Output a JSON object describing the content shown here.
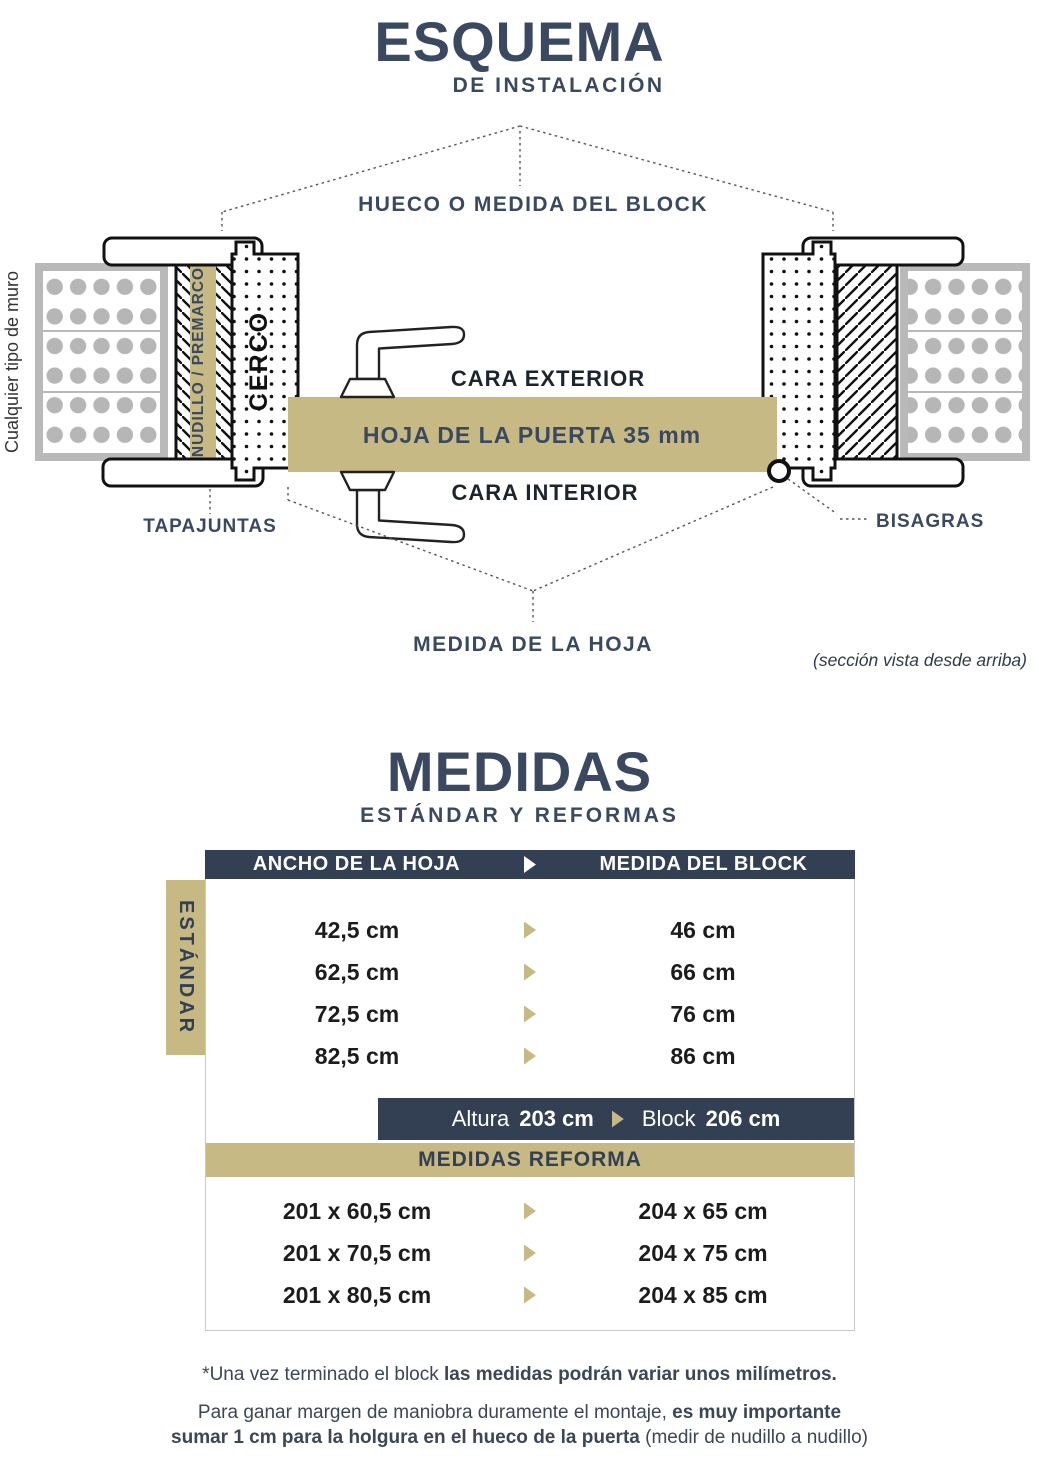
{
  "colors": {
    "navy": "#3a4960",
    "bar_navy": "#333f52",
    "gold": "#c6b983",
    "wall_gray": "#b6b6b6",
    "ink": "#1d242e"
  },
  "esquema": {
    "title": "ESQUEMA",
    "subtitle": "DE INSTALACIÓN",
    "hueco_label": "HUECO O MEDIDA DEL BLOCK",
    "wall_label": "Cualquier tipo de muro",
    "nudillo_label": "NUDILLO / PREMARCO",
    "cerco_label": "CERCO",
    "cara_exterior": "CARA EXTERIOR",
    "hoja_label": "HOJA DE LA PUERTA  35 mm",
    "cara_interior": "CARA INTERIOR",
    "tapajuntas_label": "TAPAJUNTAS",
    "bisagras_label": "BISAGRAS",
    "medida_hoja_label": "MEDIDA DE LA HOJA",
    "section_note": "(sección vista desde arriba)"
  },
  "medidas": {
    "title": "MEDIDAS",
    "subtitle": "ESTÁNDAR Y REFORMAS",
    "header_left": "ANCHO DE LA HOJA",
    "header_right": "MEDIDA DEL BLOCK",
    "estandar_tab": "ESTÁNDAR",
    "standard_rows": [
      {
        "hoja": "42,5 cm",
        "block": "46 cm"
      },
      {
        "hoja": "62,5 cm",
        "block": "66 cm"
      },
      {
        "hoja": "72,5 cm",
        "block": "76 cm"
      },
      {
        "hoja": "82,5 cm",
        "block": "86 cm"
      }
    ],
    "altura": {
      "label_a": "Altura",
      "value_a": "203 cm",
      "label_b": "Block",
      "value_b": "206 cm"
    },
    "reforma_header": "MEDIDAS REFORMA",
    "reforma_rows": [
      {
        "hoja": "201 x 60,5 cm",
        "block": "204 x 65 cm"
      },
      {
        "hoja": "201 x 70,5 cm",
        "block": "204 x 75 cm"
      },
      {
        "hoja": "201 x 80,5 cm",
        "block": "204 x 85 cm"
      }
    ]
  },
  "footnotes": {
    "line1_normal": "*Una vez terminado el block ",
    "line1_bold": "las medidas podrán variar unos milímetros.",
    "line2_normal": "Para ganar margen de maniobra duramente el montaje, ",
    "line2_bold": "es muy importante",
    "line3_bold": "sumar 1 cm para la holgura en el hueco de la puerta ",
    "line3_normal": "(medir de nudillo a nudillo)"
  }
}
